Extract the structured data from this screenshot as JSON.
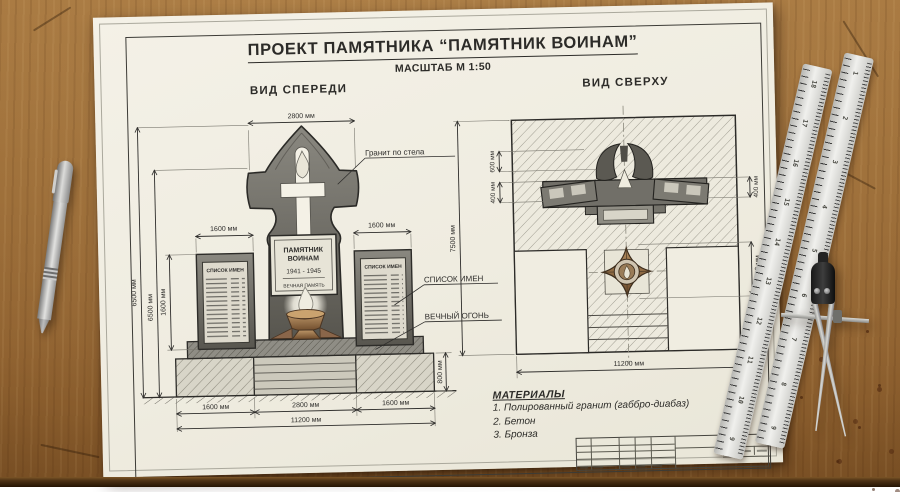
{
  "header": {
    "title": "ПРОЕКТ ПАМЯТНИКА “ПАМЯТНИК ВОИНАМ”",
    "scale": "МАСШТАБ М 1:50"
  },
  "front_view": {
    "label": "ВИД СПЕРЕДИ",
    "plaque": {
      "line1": "ПАМЯТНИК",
      "line2": "ВОИНАМ",
      "years": "1941 - 1945",
      "memory": "ВЕЧНАЯ ПАМЯТЬ"
    },
    "slab_header_left": "СПИСОК ИМЕН",
    "slab_header_right": "СПИСОК ИМЕН",
    "annotations": {
      "granite": "Гранит по стела",
      "names_list": "СПИСОК ИМЕН",
      "eternal_flame": "ВЕЧНЫЙ ОГОНЬ"
    },
    "dims": {
      "top_width": "2800 мм",
      "height_total": "6500 мм",
      "height_inner": "6500 мм",
      "slab_height": "1600 мм",
      "slab_width_left": "1600 мм",
      "slab_width_right": "1600 мм",
      "base_height": "800 мм",
      "bottom_left": "1600 мм",
      "bottom_center": "2800 мм",
      "bottom_right": "1600 мм",
      "total_width": "11200 мм"
    }
  },
  "top_view": {
    "label": "ВИД СВЕРХУ",
    "dims": {
      "side_total": "7500 мм",
      "flame_depth": "600 мм",
      "slab_depth": "400 мм",
      "right_offset": "400 мм",
      "flame_size": "1500 мм",
      "total_width": "11200 мм"
    }
  },
  "materials": {
    "heading": "МАТЕРИАЛЫ",
    "items": [
      "1. Полированный гранит (габбро-диабаз)",
      "2. Бетон",
      "3. Бронза"
    ]
  },
  "tools": {
    "ruler_left_numbers": [
      "18",
      "17",
      "16",
      "15",
      "14",
      "13",
      "12",
      "11",
      "10",
      "9"
    ],
    "ruler_right_numbers": [
      "1",
      "2",
      "3",
      "4",
      "5",
      "6",
      "7",
      "8",
      "9"
    ]
  }
}
